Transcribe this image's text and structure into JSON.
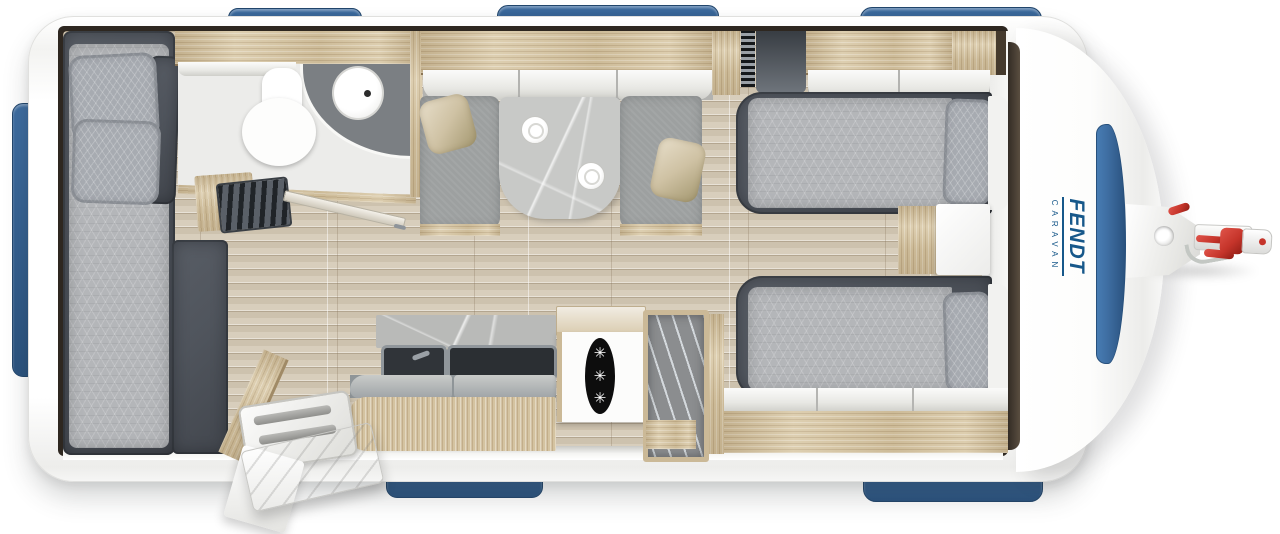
{
  "branding": {
    "name": "FENDT",
    "subname": "CARAVAN"
  },
  "fridge": {
    "symbols": [
      "✳",
      "✳",
      "✳"
    ]
  },
  "colors": {
    "accent_blue": "#3e6da1",
    "accent_blue_dark": "#2a527e",
    "logo_blue": "#17588a",
    "hitch_red": "#c5342a",
    "charcoal": "#50555d",
    "duvet_gray": "#b4b6b9",
    "cushion_gray": "#9da0a0",
    "pillow_gold": "#cfc2a4",
    "wood_light": "#d8c7a4",
    "floor_beige": "#d2c7b2",
    "table_stone": "#c8c9c7",
    "wall_dark": "#2e2720",
    "fridge_black": "#0d0d0d"
  }
}
